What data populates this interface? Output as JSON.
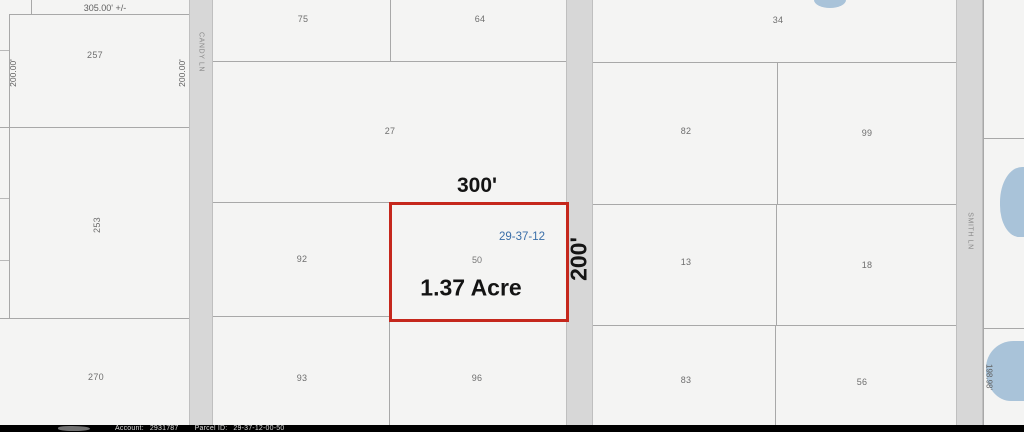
{
  "map": {
    "highlight_parcel": {
      "width_label": "300'",
      "height_label": "200'",
      "area_label": "1.37 Acre",
      "section_label": "29-37-12",
      "number": "50",
      "border_color": "#c5271c",
      "section_color": "#3a6ea8"
    },
    "roads": {
      "candy_ln": "CANDY LN",
      "smith_ln": "SMITH LN"
    },
    "dimensions": {
      "top_left": "305.00' +/-",
      "left_side": "200.00'",
      "right_side": "200.00'",
      "bottom_right": "198.98'"
    },
    "parcel_numbers": {
      "p257": "257",
      "p75": "75",
      "p64": "64",
      "p34": "34",
      "p27": "27",
      "p82": "82",
      "p99": "99",
      "p253": "253",
      "p92": "92",
      "p13": "13",
      "p18": "18",
      "p270": "270",
      "p93": "93",
      "p96": "96",
      "p83": "83",
      "p56": "56"
    },
    "colors": {
      "pond": "#a9c3d9",
      "road": "#d7d7d7",
      "background": "#f4f4f3"
    }
  },
  "footer": {
    "account_label": "Account:",
    "account_value": "2931787",
    "parcel_id_label": "Parcel ID:",
    "parcel_id_value": "29-37-12-00-50"
  }
}
